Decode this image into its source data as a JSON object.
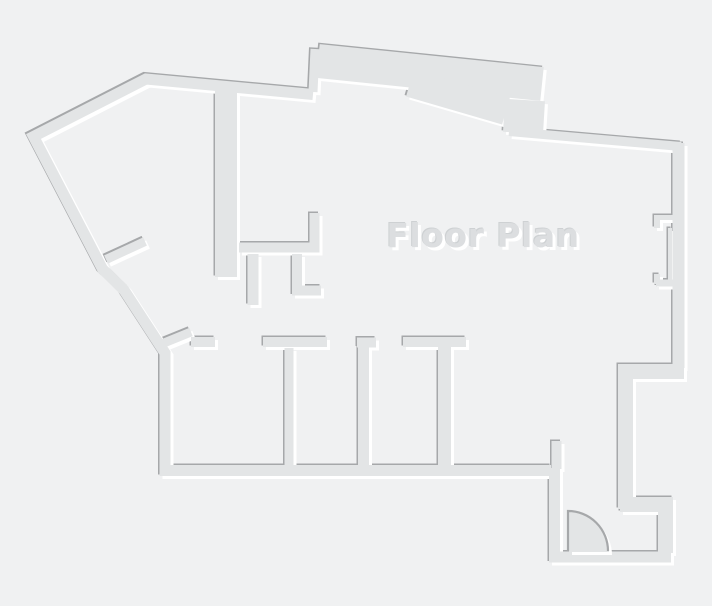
{
  "title": "Floor Plan",
  "canvas": {
    "width": 712,
    "height": 606
  },
  "colors": {
    "background": "#f0f1f2",
    "wall_fill": "#e3e5e6",
    "wall_shadow": "#a6a8aa",
    "wall_highlight": "#ffffff",
    "title_fill": "#dcdee0",
    "title_shadow": "#ced1d3",
    "title_highlight": "#ffffff"
  }
}
